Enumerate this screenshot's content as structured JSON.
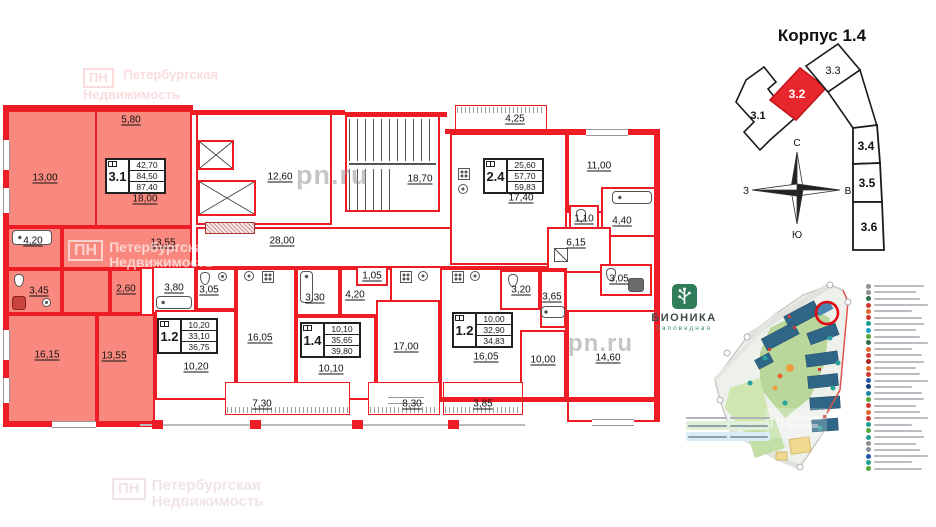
{
  "colors": {
    "wall_red": "#ee1c25",
    "apartment_highlight_fill": "#f9897f",
    "scheme_highlight_red": "#e8262d",
    "logo_green": "#2f7d5a",
    "map_highlight": "#e30613"
  },
  "floor_plan": {
    "info_blocks": {
      "a31": {
        "type": "3.1",
        "v1": "42,70",
        "v2": "84,50",
        "v3": "87,40"
      },
      "a24": {
        "type": "2.4",
        "v1": "25,60",
        "v2": "57,70",
        "v3": "59,83"
      },
      "a12l": {
        "type": "1.2",
        "v1": "10,20",
        "v2": "33,10",
        "v3": "36,75"
      },
      "a14": {
        "type": "1.4",
        "v1": "10,10",
        "v2": "35,65",
        "v3": "39,80"
      },
      "a12r": {
        "type": "1.2",
        "v1": "10,00",
        "v2": "32,90",
        "v3": "34,83"
      }
    },
    "room_labels": {
      "r580": "5,80",
      "r1300": "13,00",
      "r1800": "18,00",
      "r420a": "4,20",
      "r1355a": "13,55",
      "r345": "3,45",
      "r260": "2,60",
      "r1615": "16,15",
      "r1355b": "13,55",
      "r1260": "12,60",
      "r1870": "18,70",
      "r2800": "28,00",
      "r425": "4,25",
      "r1740": "17,40",
      "r1100": "11,00",
      "r110": "1,10",
      "r440": "4,40",
      "r615": "6,15",
      "r305c": "3,05",
      "r380": "3,80",
      "r305a": "3,05",
      "r1605a": "16,05",
      "r1020": "10,20",
      "r330": "3,30",
      "r420b": "4,20",
      "r105": "1,05",
      "r1010": "10,10",
      "r1700": "17,00",
      "r320": "3,20",
      "r365": "3,65",
      "r1605b": "16,05",
      "r1000": "10,00",
      "r1460": "14,60",
      "r730": "7,30",
      "r830": "8,30",
      "r385": "3,85"
    }
  },
  "scheme": {
    "title": "Корпус 1.4",
    "sections": [
      {
        "label": "3.1",
        "highlighted": false
      },
      {
        "label": "3.2",
        "highlighted": true
      },
      {
        "label": "3.3",
        "highlighted": false
      },
      {
        "label": "3.4",
        "highlighted": false
      },
      {
        "label": "3.5",
        "highlighted": false
      },
      {
        "label": "3.6",
        "highlighted": false
      }
    ],
    "compass": {
      "north": "С",
      "south": "Ю",
      "west": "З",
      "east": "В"
    }
  },
  "logo": {
    "title": "БИОНИКА",
    "subtitle": "Заповедная"
  },
  "watermarks": {
    "pn_box": "ПН",
    "brand_line1": "Петербургская",
    "brand_line2": "Недвижимость",
    "site": "pn.ru"
  },
  "site_map": {
    "highlight_color": "#e30613",
    "legend_marker_colors": [
      "#8a8f94",
      "#8a8f94",
      "#2f6f4f",
      "#d03a34",
      "#e2672e",
      "#d03a34",
      "#1f9e94",
      "#16a3c4",
      "#58a53a",
      "#2f6f4f",
      "#e2672e",
      "#d03a34",
      "#a82323",
      "#e2672e",
      "#d03a34",
      "#2456a8",
      "#1b3f7a",
      "#1f86a8",
      "#58a53a",
      "#d03a34",
      "#e2672e",
      "#d03a34",
      "#1f9e94",
      "#58a53a",
      "#1f9e94",
      "#8a8f94",
      "#8a8f94",
      "#2456a8",
      "#1f9e94",
      "#58a53a"
    ]
  }
}
